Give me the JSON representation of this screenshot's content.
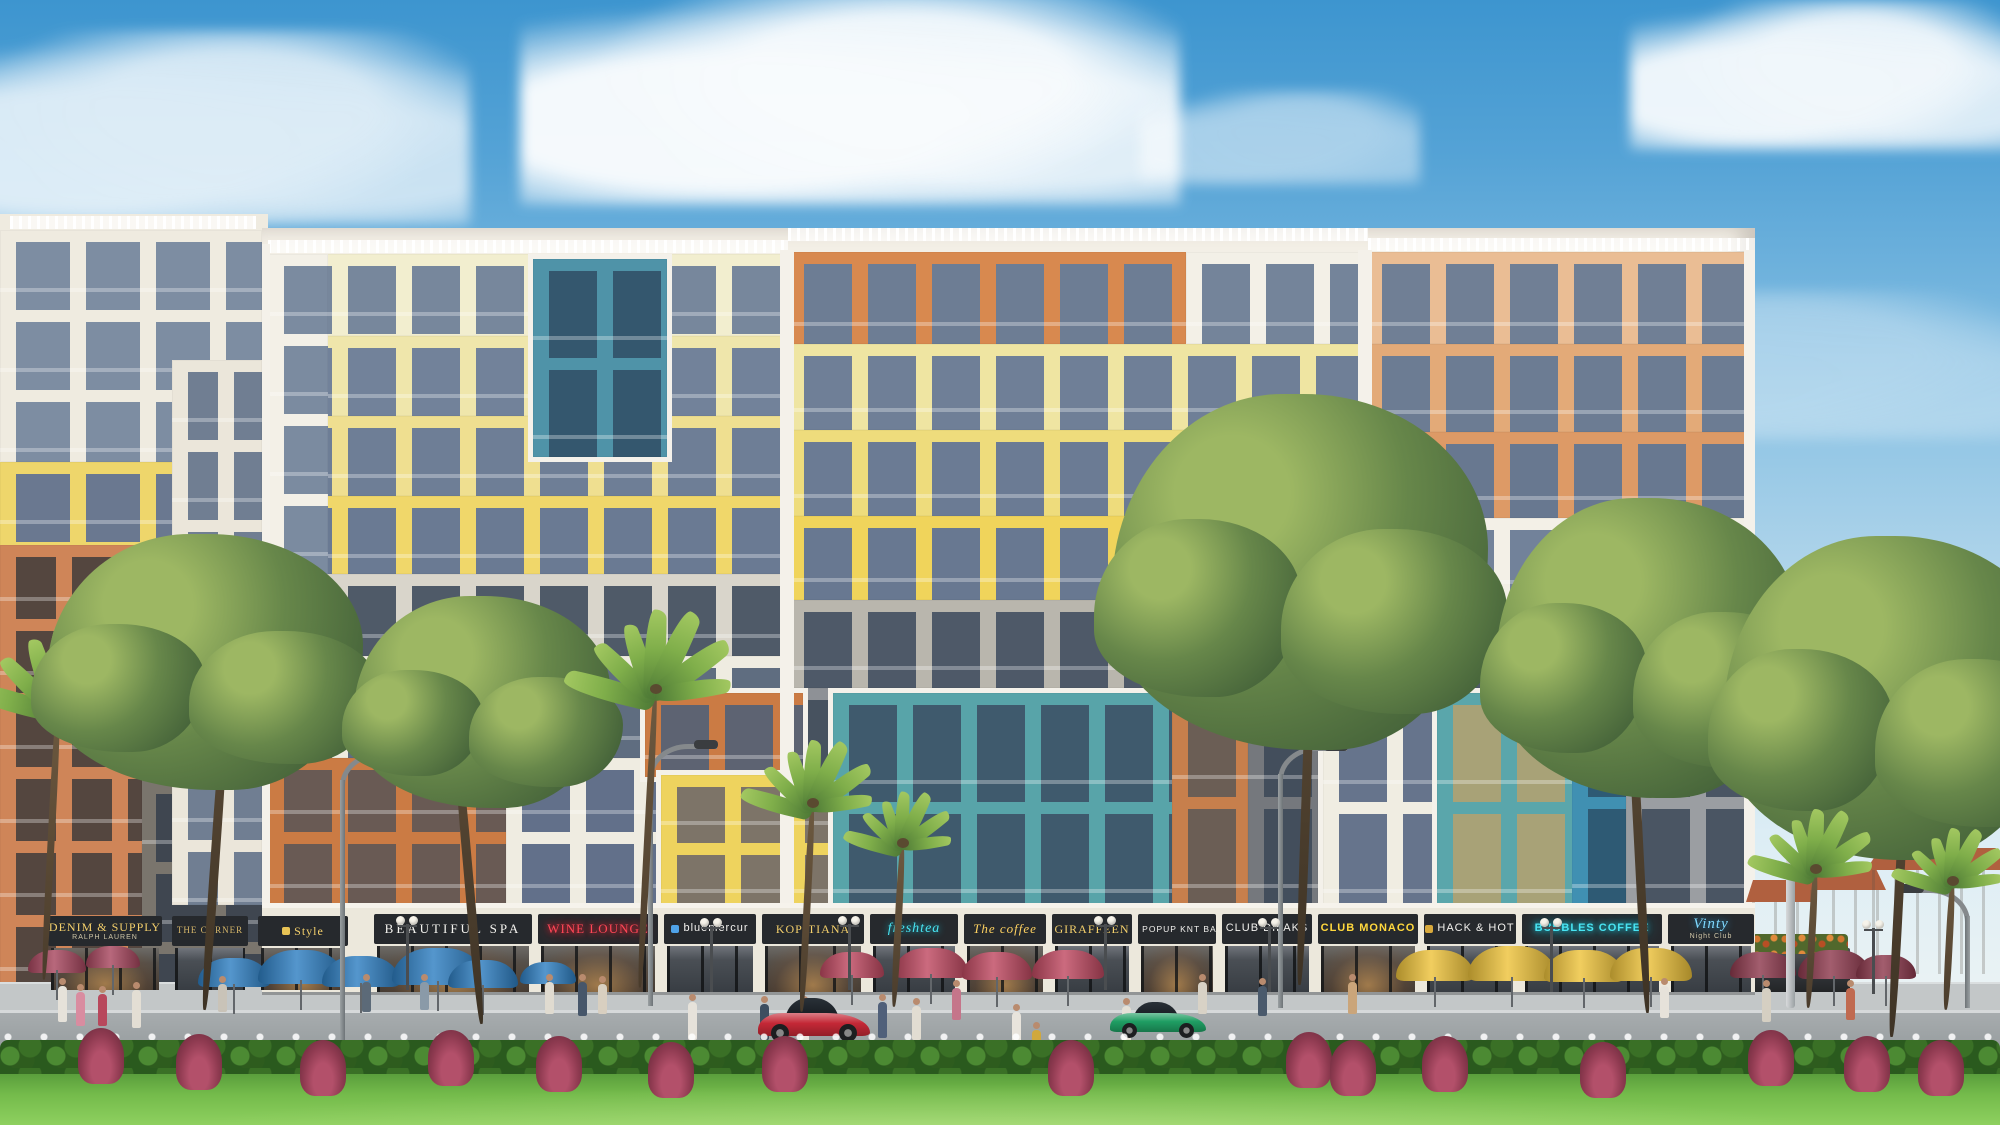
{
  "scene_label": "colorful mixed-use apartment building with ground-floor shops, lawn and trees",
  "palette": {
    "sky_top": "#3d95cf",
    "sky_low": "#e3eff5",
    "facade_white": "#f3efe6",
    "cream": "#f2eecf",
    "pale_yellow": "#efe6ab",
    "yellow": "#f0d76a",
    "teal": "#4f93a8",
    "teal_stripe": "#58a4a9",
    "orange": "#d8894f",
    "orange_stripe": "#cb7b44",
    "salmon": "#e3aa78",
    "gray": "#b9b6ad",
    "glass": "#6e7e96",
    "shop_dark": "#26292d",
    "gold": "#f3cf6b",
    "neon_red": "#ff4757",
    "neon_cyan": "#49e4f2",
    "neon_blue": "#7fd9ff",
    "street": "#9aa0a2",
    "sidewalk": "#c3c7c8",
    "lawn": "#7cc04f",
    "hedge": "#2f621f",
    "foliage": "#67874a",
    "palm": "#7fae4a",
    "trunk": "#4a3c2c",
    "car_red": "#c42836",
    "car_green": "#1f9e63",
    "umbrella_blue": "#2f7fc2",
    "umbrella_red": "#c04a62",
    "umbrella_yellow": "#eec33c",
    "umbrella_maroon": "#8e3a4e",
    "villa_roof": "#b0603f"
  },
  "shops": {
    "left": [
      {
        "x": 48,
        "w": 114,
        "label": "DENIM & SUPPLY",
        "sub": "RALPH LAUREN",
        "style": "gold",
        "glow": true
      },
      {
        "x": 172,
        "w": 76,
        "label": "THE CORNER",
        "style": "gold-sm",
        "glow": false
      },
      {
        "x": 258,
        "w": 90,
        "label": "Style",
        "style": "gold",
        "glow": true,
        "icon": "#e8c355"
      }
    ],
    "main": [
      {
        "x": 374,
        "w": 158,
        "label": "BEAUTIFUL SPA",
        "style": "serif-white",
        "glow": true
      },
      {
        "x": 538,
        "w": 120,
        "label": "WINE LOUNGE",
        "style": "neon-red",
        "glow": true
      },
      {
        "x": 664,
        "w": 92,
        "label": "bluemercur",
        "style": "white",
        "glow": false,
        "icon": "#4fa3e8"
      },
      {
        "x": 762,
        "w": 102,
        "label": "KOPITIANA",
        "style": "gold",
        "glow": true
      },
      {
        "x": 870,
        "w": 88,
        "label": "freshtea",
        "style": "neon-cyan-script",
        "glow": false
      },
      {
        "x": 964,
        "w": 82,
        "label": "The coffee",
        "style": "gold-script",
        "glow": true
      },
      {
        "x": 1052,
        "w": 80,
        "label": "GIRAFFEEN",
        "style": "gold",
        "glow": false
      },
      {
        "x": 1138,
        "w": 78,
        "label": "POPUP KNT BAR",
        "style": "white-sm",
        "glow": true,
        "icon": "#c43b33"
      },
      {
        "x": 1222,
        "w": 90,
        "label": "CLUB DILAKS",
        "style": "white",
        "glow": false
      },
      {
        "x": 1318,
        "w": 100,
        "label": "CLUB MONACO",
        "style": "yellow",
        "glow": true
      },
      {
        "x": 1424,
        "w": 92,
        "label": "HACK & HOT",
        "style": "white",
        "glow": false,
        "icon": "#d8a93c"
      },
      {
        "x": 1522,
        "w": 140,
        "label": "BUBBLES COFFEE",
        "style": "neon-cyan",
        "glow": false
      },
      {
        "x": 1668,
        "w": 86,
        "label": "Vinty",
        "sub": "Night Club",
        "style": "neon-blue-script",
        "glow": false
      }
    ]
  },
  "left_building": {
    "base": {
      "x": 0,
      "y": 214,
      "w": 268,
      "h": 780
    },
    "blocks": [
      {
        "n": "white-top",
        "x": 0,
        "y": 230,
        "w": 262,
        "h": 232,
        "f": "#efebe0",
        "g": "#7d8da2",
        "b": 70
      },
      {
        "n": "yellow-mid",
        "x": 0,
        "y": 462,
        "w": 262,
        "h": 240,
        "f": "#eed66b",
        "g": "#6a7890",
        "b": 70
      },
      {
        "n": "gray-low",
        "x": 0,
        "y": 702,
        "w": 262,
        "h": 288,
        "f": "#7a756d",
        "g": "#3f4650",
        "b": 70
      },
      {
        "n": "orange-tower",
        "x": 0,
        "y": 545,
        "w": 142,
        "h": 462,
        "f": "#cf8558",
        "g": "#54463f",
        "b": 56,
        "fl": 74
      },
      {
        "n": "white-gap-tower",
        "x": 172,
        "y": 360,
        "w": 90,
        "h": 545,
        "f": "#ebe6da",
        "g": "#707e92",
        "b": 46
      }
    ]
  },
  "main_building": {
    "base": {
      "x": 262,
      "y": 228,
      "w": 1493,
      "h": 762
    },
    "rails": [
      {
        "x": 268,
        "y": 240,
        "w": 520
      },
      {
        "x": 788,
        "y": 228,
        "w": 580
      },
      {
        "x": 1368,
        "y": 238,
        "w": 387
      },
      {
        "x": 10,
        "y": 216,
        "w": 246
      }
    ],
    "piers": [
      {
        "x": 780,
        "y": 250,
        "w": 14,
        "h": 656
      },
      {
        "x": 1358,
        "y": 250,
        "w": 14,
        "h": 440
      },
      {
        "x": 262,
        "y": 244,
        "w": 8,
        "h": 746
      },
      {
        "x": 1744,
        "y": 250,
        "w": 11,
        "h": 740
      }
    ],
    "blocks": [
      {
        "n": "cream-f1",
        "x": 268,
        "y": 254,
        "w": 520,
        "h": 82,
        "f": "#f2eecf",
        "g": "#77879c"
      },
      {
        "n": "cream-f2",
        "x": 268,
        "y": 336,
        "w": 520,
        "h": 80,
        "f": "#efe6ab",
        "g": "#72829a"
      },
      {
        "n": "yellow-f3",
        "x": 268,
        "y": 416,
        "w": 520,
        "h": 80,
        "f": "#efdf90",
        "g": "#6e7e96"
      },
      {
        "n": "yellow-f4",
        "x": 268,
        "y": 496,
        "w": 520,
        "h": 78,
        "f": "#f0d76a",
        "g": "#6a7a93"
      },
      {
        "n": "white-col",
        "x": 268,
        "y": 254,
        "w": 60,
        "h": 320,
        "f": "#f3f0e7",
        "g": "#7b8ba0"
      },
      {
        "n": "teal-block",
        "x": 528,
        "y": 254,
        "w": 134,
        "h": 198,
        "f": "#4f93a8",
        "g": "#34576e",
        "fl": 99,
        "bd": 1
      },
      {
        "n": "gray-mid",
        "x": 268,
        "y": 574,
        "w": 520,
        "h": 82,
        "f": "#d9d5cb",
        "g": "#4f5a68",
        "fl": 82
      },
      {
        "n": "white-low",
        "x": 268,
        "y": 656,
        "w": 520,
        "h": 102,
        "f": "#efece1",
        "g": "#5f6d80",
        "fl": 102
      },
      {
        "n": "orange-low",
        "x": 268,
        "y": 758,
        "w": 238,
        "h": 148,
        "f": "#cb7b44",
        "g": "#695a54",
        "fl": 74
      },
      {
        "n": "white-low-r",
        "x": 506,
        "y": 758,
        "w": 282,
        "h": 148,
        "f": "#efece1",
        "g": "#62708a",
        "fl": 74
      },
      {
        "n": "orange-top",
        "x": 788,
        "y": 252,
        "w": 398,
        "h": 92,
        "f": "#d8894f",
        "g": "#6d7d94",
        "fl": 92
      },
      {
        "n": "white-tr",
        "x": 1186,
        "y": 252,
        "w": 180,
        "h": 92,
        "f": "#f3f0e7",
        "g": "#74849a",
        "fl": 92
      },
      {
        "n": "yellow-c1",
        "x": 788,
        "y": 344,
        "w": 578,
        "h": 86,
        "f": "#efe5a2",
        "g": "#6f7f97",
        "fl": 86
      },
      {
        "n": "yellow-c2",
        "x": 788,
        "y": 430,
        "w": 578,
        "h": 86,
        "f": "#eedc7c",
        "g": "#6b7b94",
        "fl": 86
      },
      {
        "n": "yellow-c3",
        "x": 788,
        "y": 516,
        "w": 578,
        "h": 84,
        "f": "#f0d45b",
        "g": "#687891",
        "fl": 84
      },
      {
        "n": "gray-c",
        "x": 788,
        "y": 600,
        "w": 578,
        "h": 88,
        "f": "#b9b6ad",
        "g": "#4e5968",
        "fl": 88
      },
      {
        "n": "salmon-1",
        "x": 1366,
        "y": 252,
        "w": 389,
        "h": 92,
        "f": "#eabd94",
        "g": "#707f95",
        "fl": 92
      },
      {
        "n": "salmon-2",
        "x": 1366,
        "y": 344,
        "w": 389,
        "h": 88,
        "f": "#e3aa78",
        "g": "#6c7c93",
        "fl": 88
      },
      {
        "n": "salmon-3",
        "x": 1366,
        "y": 432,
        "w": 389,
        "h": 86,
        "f": "#dd9a66",
        "g": "#687890",
        "fl": 86
      },
      {
        "n": "white-r",
        "x": 1366,
        "y": 518,
        "w": 389,
        "h": 84,
        "f": "#f3f0e7",
        "g": "#72829a",
        "fl": 84
      },
      {
        "n": "gray-r",
        "x": 1366,
        "y": 602,
        "w": 389,
        "h": 86,
        "f": "#b9b6ad",
        "g": "#4e5968",
        "fl": 86
      },
      {
        "n": "gray-low-r",
        "x": 1626,
        "y": 688,
        "w": 129,
        "h": 218,
        "f": "#9b9ea2",
        "g": "#4a5563",
        "fl": 109
      },
      {
        "n": "gray-gap",
        "x": 788,
        "y": 688,
        "w": 44,
        "h": 218,
        "f": "#8e9196",
        "g": "#47525f",
        "fl": 109
      },
      {
        "n": "orange-str",
        "x": 640,
        "y": 688,
        "w": 158,
        "h": 84,
        "f": "#cb7b44",
        "g": "#5d6372",
        "fl": 84,
        "bd": 1
      },
      {
        "n": "yellow-str",
        "x": 656,
        "y": 770,
        "w": 172,
        "h": 136,
        "f": "#eed35e",
        "g": "#7d7468",
        "fl": 68,
        "bd": 1
      },
      {
        "n": "teal-str",
        "x": 828,
        "y": 688,
        "w": 344,
        "h": 218,
        "f": "#58a4a9",
        "g": "#3f5a6d",
        "fl": 109,
        "bd": 1
      },
      {
        "n": "orange-col",
        "x": 1172,
        "y": 688,
        "w": 76,
        "h": 218,
        "f": "#c77f4c",
        "g": "#6b5e55",
        "fl": 109
      },
      {
        "n": "gray-col",
        "x": 1248,
        "y": 688,
        "w": 70,
        "h": 218,
        "f": "#75787d",
        "g": "#434e5c",
        "fl": 109
      },
      {
        "n": "white-low2",
        "x": 1318,
        "y": 688,
        "w": 114,
        "h": 218,
        "f": "#f0ede2",
        "g": "#66748c",
        "fl": 109,
        "bd": 1
      },
      {
        "n": "teal-yellow",
        "x": 1432,
        "y": 688,
        "w": 140,
        "h": 218,
        "f": "#5aa6ab",
        "g": "#a8a277",
        "fl": 109,
        "bd": 1
      },
      {
        "n": "blue-col",
        "x": 1572,
        "y": 688,
        "w": 54,
        "h": 218,
        "f": "#4090b2",
        "g": "#2e5a74",
        "fl": 109
      }
    ]
  },
  "clouds": [
    {
      "x": 520,
      "y": -10,
      "w": 660,
      "h": 215,
      "o": 0.96
    },
    {
      "x": -90,
      "y": 30,
      "w": 560,
      "h": 195,
      "o": 0.8
    },
    {
      "x": 1630,
      "y": 0,
      "w": 390,
      "h": 150,
      "o": 0.92
    },
    {
      "x": 1140,
      "y": 90,
      "w": 280,
      "h": 95,
      "o": 0.5
    },
    {
      "x": 1440,
      "y": 290,
      "w": 580,
      "h": 150,
      "o": 0.35
    },
    {
      "x": 240,
      "y": 250,
      "w": 520,
      "h": 130,
      "o": 0.28
    }
  ],
  "trees": [
    {
      "type": "palm",
      "cx": 58,
      "cy": 700,
      "r": 92,
      "trunk": 280
    },
    {
      "type": "leafy",
      "cx": 205,
      "cy": 662,
      "rx": 158,
      "ry": 128,
      "trunk": 310,
      "lean": 4
    },
    {
      "type": "leafy",
      "cx": 482,
      "cy": 702,
      "rx": 128,
      "ry": 106,
      "trunk": 290,
      "lean": -5
    },
    {
      "type": "palm",
      "cx": 655,
      "cy": 688,
      "r": 96,
      "trunk": 300
    },
    {
      "type": "palm",
      "cx": 812,
      "cy": 802,
      "r": 76,
      "trunk": 210
    },
    {
      "type": "palm",
      "cx": 902,
      "cy": 842,
      "r": 62,
      "trunk": 165
    },
    {
      "type": "leafy",
      "cx": 1300,
      "cy": 572,
      "rx": 188,
      "ry": 178,
      "trunk": 360,
      "lean": 2
    },
    {
      "type": "leafy",
      "cx": 1648,
      "cy": 648,
      "rx": 152,
      "ry": 150,
      "trunk": 320,
      "lean": -3
    },
    {
      "type": "leafy",
      "cx": 1892,
      "cy": 698,
      "rx": 168,
      "ry": 162,
      "trunk": 290,
      "lean": 3
    },
    {
      "type": "palm",
      "cx": 1815,
      "cy": 868,
      "r": 72,
      "trunk": 140
    },
    {
      "type": "palm",
      "cx": 1952,
      "cy": 880,
      "r": 64,
      "trunk": 130
    }
  ],
  "umbrella_groups": [
    {
      "name": "maroon-left",
      "color": "#a8475f",
      "items": [
        {
          "x": 28,
          "y": 950,
          "w": 58
        },
        {
          "x": 86,
          "y": 946,
          "w": 54
        }
      ]
    },
    {
      "name": "blue",
      "color": "#2f7fc2",
      "items": [
        {
          "x": 198,
          "y": 958,
          "w": 72
        },
        {
          "x": 258,
          "y": 950,
          "w": 86
        },
        {
          "x": 322,
          "y": 956,
          "w": 78
        },
        {
          "x": 392,
          "y": 948,
          "w": 92
        },
        {
          "x": 448,
          "y": 960,
          "w": 70
        },
        {
          "x": 520,
          "y": 962,
          "w": 56
        }
      ]
    },
    {
      "name": "red-center",
      "color": "#c04a62",
      "items": [
        {
          "x": 820,
          "y": 952,
          "w": 64
        },
        {
          "x": 894,
          "y": 948,
          "w": 74
        },
        {
          "x": 962,
          "y": 952,
          "w": 70
        },
        {
          "x": 1032,
          "y": 950,
          "w": 72
        }
      ]
    },
    {
      "name": "yellow-right",
      "color": "#eec33c",
      "items": [
        {
          "x": 1396,
          "y": 950,
          "w": 78
        },
        {
          "x": 1468,
          "y": 946,
          "w": 88
        },
        {
          "x": 1544,
          "y": 950,
          "w": 80
        },
        {
          "x": 1610,
          "y": 948,
          "w": 82
        }
      ]
    },
    {
      "name": "maroon-right",
      "color": "#8e3a4e",
      "items": [
        {
          "x": 1730,
          "y": 952,
          "w": 66
        },
        {
          "x": 1798,
          "y": 950,
          "w": 72
        },
        {
          "x": 1856,
          "y": 955,
          "w": 60
        }
      ]
    }
  ],
  "lamps": {
    "curved": [
      {
        "x": 340,
        "top": 752,
        "h": 336
      },
      {
        "x": 648,
        "top": 744,
        "h": 262
      },
      {
        "x": 1278,
        "top": 746,
        "h": 262
      },
      {
        "x": 1898,
        "top": 888,
        "h": 120,
        "flip": true
      }
    ],
    "poles": [
      {
        "x": 1786,
        "top": 858,
        "h": 150,
        "w": 9
      }
    ],
    "globes": [
      {
        "x": 396,
        "top": 916
      },
      {
        "x": 700,
        "top": 918
      },
      {
        "x": 838,
        "top": 916
      },
      {
        "x": 1094,
        "top": 916
      },
      {
        "x": 1258,
        "top": 918
      },
      {
        "x": 1540,
        "top": 918
      },
      {
        "x": 1862,
        "top": 920
      }
    ]
  },
  "people": [
    {
      "x": 58,
      "feet": 1022,
      "h": 44,
      "c": "#e6e2da"
    },
    {
      "x": 76,
      "feet": 1026,
      "h": 42,
      "c": "#d98ca0"
    },
    {
      "x": 98,
      "feet": 1026,
      "h": 40,
      "c": "#b8485c"
    },
    {
      "x": 132,
      "feet": 1028,
      "h": 46,
      "c": "#e3ded4"
    },
    {
      "x": 218,
      "feet": 1012,
      "h": 36,
      "c": "#c9c3b8"
    },
    {
      "x": 362,
      "feet": 1012,
      "h": 38,
      "c": "#5c6a78"
    },
    {
      "x": 420,
      "feet": 1010,
      "h": 36,
      "c": "#8a9aa8"
    },
    {
      "x": 545,
      "feet": 1014,
      "h": 40,
      "c": "#e0dbd0"
    },
    {
      "x": 578,
      "feet": 1016,
      "h": 42,
      "c": "#46566a"
    },
    {
      "x": 598,
      "feet": 1014,
      "h": 38,
      "c": "#d8cfc0"
    },
    {
      "x": 688,
      "feet": 1040,
      "h": 46,
      "c": "#e6e2da"
    },
    {
      "x": 760,
      "feet": 1040,
      "h": 44,
      "c": "#3e4e60"
    },
    {
      "x": 800,
      "feet": 1042,
      "h": 46,
      "c": "#eae6de"
    },
    {
      "x": 878,
      "feet": 1038,
      "h": 44,
      "c": "#50607a"
    },
    {
      "x": 912,
      "feet": 1040,
      "h": 42,
      "c": "#e2ddd2"
    },
    {
      "x": 952,
      "feet": 1020,
      "h": 40,
      "c": "#c5758a"
    },
    {
      "x": 1012,
      "feet": 1044,
      "h": 40,
      "c": "#e8e4dc"
    },
    {
      "x": 1032,
      "feet": 1048,
      "h": 26,
      "c": "#d0a83c"
    },
    {
      "x": 1122,
      "feet": 1042,
      "h": 44,
      "c": "#e4e0d6"
    },
    {
      "x": 1198,
      "feet": 1014,
      "h": 40,
      "c": "#d8d2c6"
    },
    {
      "x": 1258,
      "feet": 1016,
      "h": 38,
      "c": "#4a5a6c"
    },
    {
      "x": 1348,
      "feet": 1014,
      "h": 40,
      "c": "#caa57a"
    },
    {
      "x": 1660,
      "feet": 1018,
      "h": 40,
      "c": "#e6e2da"
    },
    {
      "x": 1762,
      "feet": 1022,
      "h": 42,
      "c": "#d5cfc2"
    },
    {
      "x": 1846,
      "feet": 1020,
      "h": 40,
      "c": "#c06a50"
    }
  ],
  "vehicles": [
    {
      "name": "red-sports-car",
      "x": 758,
      "y": 998,
      "w": 112,
      "h": 44,
      "c": "#c42836"
    },
    {
      "name": "green-sports-car",
      "x": 1110,
      "y": 1002,
      "w": 96,
      "h": 36,
      "c": "#1f9e63"
    }
  ],
  "planters": [
    {
      "x": 300,
      "w": 130
    },
    {
      "x": 446,
      "w": 150
    },
    {
      "x": 626,
      "w": 120
    },
    {
      "x": 788,
      "w": 160
    },
    {
      "x": 988,
      "w": 130
    },
    {
      "x": 1152,
      "w": 118
    },
    {
      "x": 1332,
      "w": 118
    },
    {
      "x": 1468,
      "w": 128
    },
    {
      "x": 1620,
      "w": 118
    },
    {
      "x": 1750,
      "w": 100
    }
  ],
  "red_plants": [
    {
      "x": 78,
      "y": 1028
    },
    {
      "x": 176,
      "y": 1034
    },
    {
      "x": 300,
      "y": 1040
    },
    {
      "x": 428,
      "y": 1030
    },
    {
      "x": 536,
      "y": 1036
    },
    {
      "x": 648,
      "y": 1042
    },
    {
      "x": 762,
      "y": 1036
    },
    {
      "x": 1048,
      "y": 1040
    },
    {
      "x": 1286,
      "y": 1032
    },
    {
      "x": 1330,
      "y": 1040
    },
    {
      "x": 1422,
      "y": 1036
    },
    {
      "x": 1580,
      "y": 1042
    },
    {
      "x": 1748,
      "y": 1030
    },
    {
      "x": 1844,
      "y": 1036
    },
    {
      "x": 1918,
      "y": 1040
    }
  ],
  "villas": [
    {
      "x": 1752,
      "y": 900,
      "w": 58,
      "h": 74
    },
    {
      "x": 1788,
      "y": 888,
      "w": 92,
      "h": 86
    },
    {
      "x": 1872,
      "y": 868,
      "w": 132,
      "h": 106
    }
  ]
}
